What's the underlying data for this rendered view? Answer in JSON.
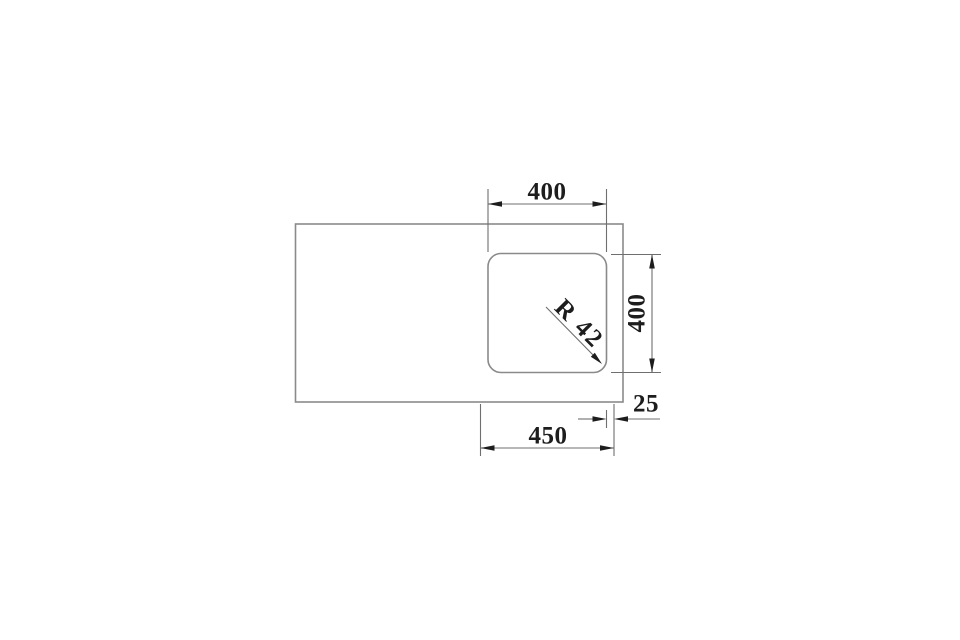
{
  "drawing": {
    "labels": {
      "cutout_width": "400",
      "cutout_depth": "400",
      "corner_radius": "R 42",
      "overall_width": "450",
      "edge_offset": "25"
    },
    "colors": {
      "background": "#ffffff",
      "outline": "#8a8a8a",
      "dimension_line": "#6f6f6f",
      "ink": "#1d1d1d"
    }
  }
}
